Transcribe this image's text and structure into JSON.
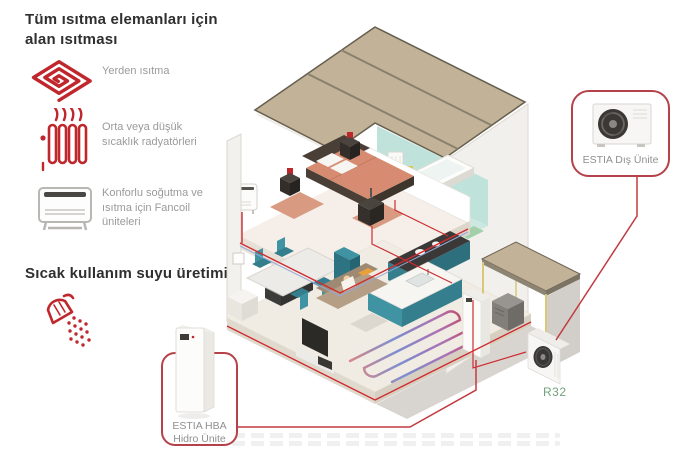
{
  "left_panel": {
    "heading": "Tüm ısıtma elemanları için alan ısıtması",
    "items": [
      {
        "icon": "floor-heating-icon",
        "label": "Yerden ısıtma"
      },
      {
        "icon": "radiator-icon",
        "label": "Orta veya düşük sıcaklık radyatörleri"
      },
      {
        "icon": "fancoil-icon",
        "label": "Konforlu soğutma ve ısıtma için Fancoil üniteleri"
      }
    ],
    "dhw_heading": "Sıcak kullanım suyu üretimi",
    "dhw_icon": "shower-icon"
  },
  "diagram": {
    "outdoor_unit_label": "ESTIA Dış Ünite",
    "hydro_unit_label_line1": "ESTIA HBA",
    "hydro_unit_label_line2": "Hidro Ünite",
    "refrigerant_label": "R32",
    "colors": {
      "accent_red": "#c0272d",
      "callout_border": "#b5424a",
      "r32_green": "#74a17e",
      "roof_tan": "#c2b297",
      "teal_furniture": "#3f93a3",
      "mint_bathroom": "#cde8e1"
    }
  }
}
